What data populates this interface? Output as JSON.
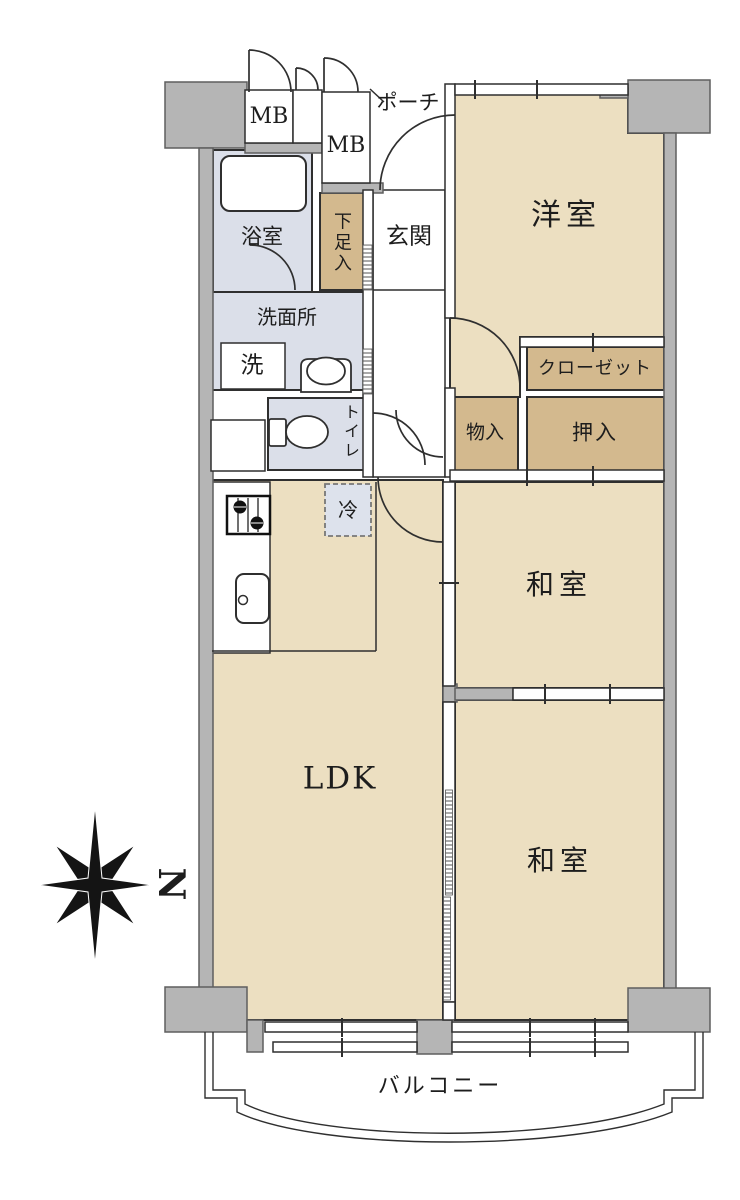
{
  "floorplan": {
    "kind": "apartment-floor-plan",
    "labels": {
      "meter_box_left": "MB",
      "meter_box_right": "MB",
      "porch": "ポーチ",
      "entrance": "玄関",
      "bathroom": "浴室",
      "shoe_storage": "下足入",
      "washroom": "洗面所",
      "washer": "洗",
      "toilet": "トイレ",
      "western_room": "洋室",
      "closet": "クローゼット",
      "storage": "物入",
      "futon_closet": "押入",
      "japanese_room_middle": "和室",
      "japanese_room_bottom": "和室",
      "ldk": "LDK",
      "refrigerator": "冷",
      "balcony": "バルコニー",
      "compass_north": "N"
    },
    "colors": {
      "room_floor": "#ecdfc1",
      "closet_floor": "#d3b98e",
      "wet_area_floor": "#dbdfe9",
      "structure_gray": "#b5b5b5",
      "line": "#2f2f2f",
      "background": "#ffffff"
    },
    "icons": {
      "compass": "compass-rose-icon",
      "bathtub": "bathtub-icon",
      "toilet": "toilet-bowl-icon",
      "basin": "wash-basin-icon",
      "stove": "stove-icon",
      "kitchen_sink": "kitchen-sink-icon",
      "refrigerator": "refrigerator-box"
    }
  }
}
